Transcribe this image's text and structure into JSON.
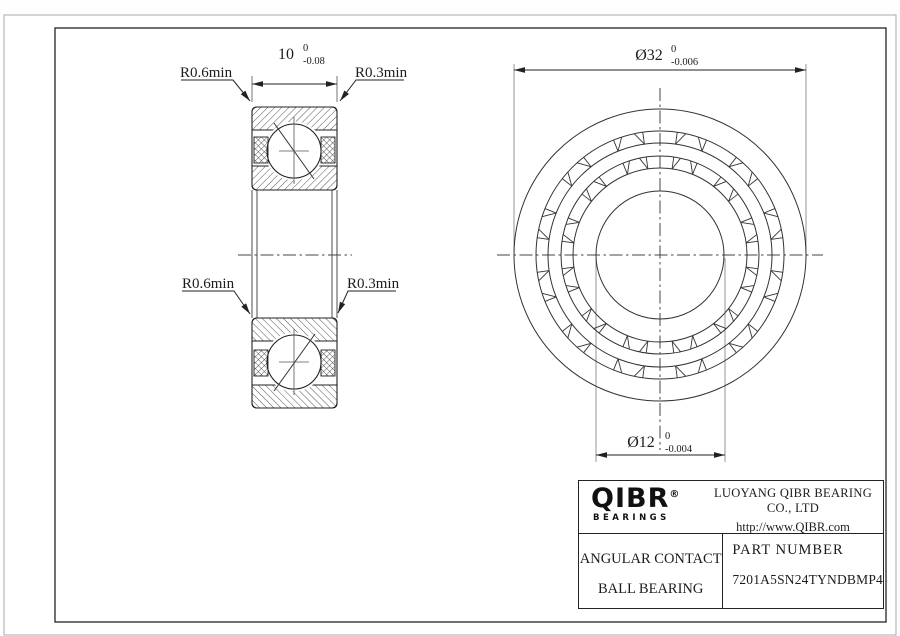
{
  "side_view": {
    "width_dim": {
      "value": "10",
      "tol_upper": "0",
      "tol_lower": "-0.08"
    },
    "labels": {
      "fillet_outer_top": "R0.6min",
      "fillet_inner_top": "R0.3min",
      "fillet_outer_bottom": "R0.6min",
      "fillet_inner_bottom": "R0.3min"
    }
  },
  "front_view": {
    "od_dim": {
      "value": "Ø32",
      "tol_upper": "0",
      "tol_lower": "-0.006"
    },
    "bore_dim": {
      "value": "Ø12",
      "tol_upper": "0",
      "tol_lower": "-0.004"
    }
  },
  "title_block": {
    "logo": {
      "wordmark": "QIBR",
      "registered": "®",
      "tagline": "BEARINGS"
    },
    "company_name": "LUOYANG QIBR BEARING CO., LTD",
    "website": "http://www.QIBR.com",
    "product_line1": "ANGULAR CONTACT",
    "product_line2": "BALL BEARING",
    "part_label": "PART NUMBER",
    "part_number": "7201A5SN24TYNDBMP4"
  }
}
